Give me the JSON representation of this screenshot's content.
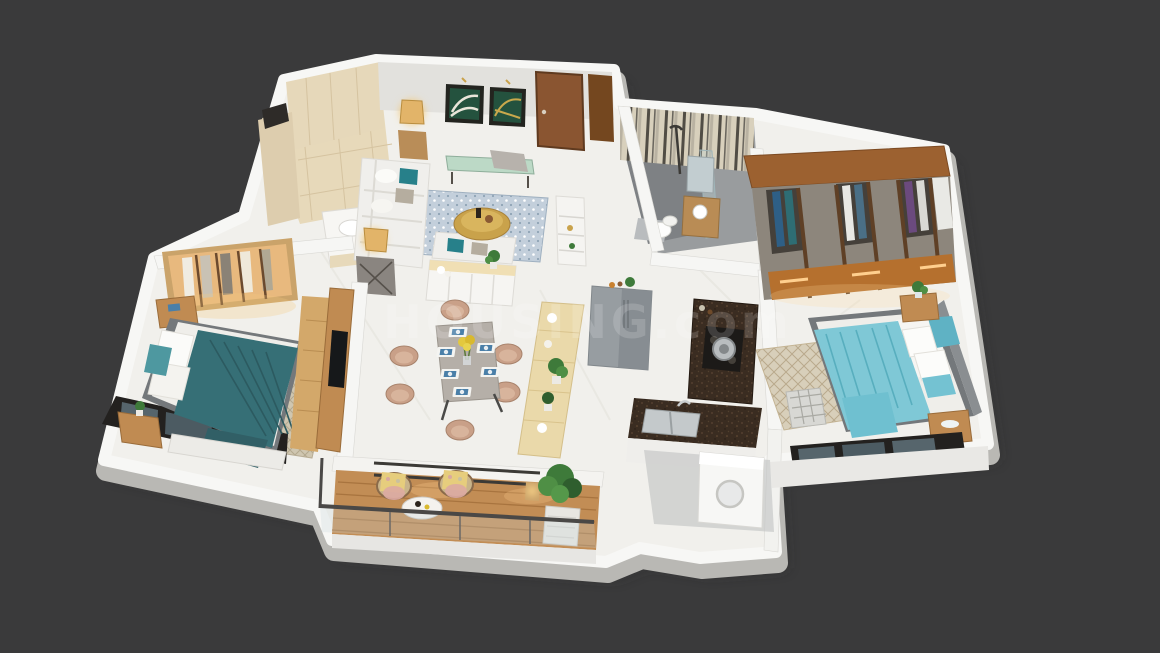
{
  "watermark": {
    "text": "HOUSING.com"
  },
  "scene": {
    "type": "3d-isometric-floor-plan-render",
    "description": "Photoreal 3D isometric cutaway floor plan of a 2-bedroom apartment on a dark charcoal background",
    "rooms": [
      {
        "name": "foyer",
        "furniture": [
          "beige-tiled-walls",
          "wash-basin-counter"
        ]
      },
      {
        "name": "living-room",
        "furniture": [
          "l-shaped-white-sofa",
          "teal-pillows",
          "two-wall-artworks",
          "wooden-entrance-door",
          "green-top-console",
          "round-gold-coffee-table",
          "blue-patterned-rug",
          "table-lamps",
          "white-sideboard"
        ]
      },
      {
        "name": "common-bathroom",
        "furniture": [
          "striped-tile-walls",
          "glass-shower",
          "wall-hung-toilet",
          "wood-vanity-with-basin",
          "mirror"
        ]
      },
      {
        "name": "dressing-room",
        "furniture": [
          "full-width-wardrobe",
          "hanging-clothes",
          "lit-drawers"
        ]
      },
      {
        "name": "master-bedroom",
        "furniture": [
          "aqua-duvet-bed",
          "white-and-aqua-pillows",
          "two-nightstands",
          "plaid-bench",
          "patterned-rug",
          "corner-windows"
        ]
      },
      {
        "name": "kitchen",
        "furniture": [
          "l-shaped-granite-counter",
          "gas-hob-with-pot",
          "double-sink",
          "grey-refrigerator"
        ]
      },
      {
        "name": "utility",
        "furniture": [
          "washing-machine"
        ]
      },
      {
        "name": "dining-area",
        "furniture": [
          "six-seater-table",
          "blush-chairs",
          "blue-placemats",
          "yellow-flower-vase"
        ]
      },
      {
        "name": "second-bedroom",
        "furniture": [
          "teal-duvet-bed",
          "lit-open-wardrobe",
          "tv-panel",
          "nightstands",
          "window-bench",
          "patterned-rug"
        ]
      },
      {
        "name": "balcony",
        "furniture": [
          "wood-deck",
          "glass-railing",
          "two-rattan-chairs",
          "round-bistro-table",
          "potted-plant",
          "lantern"
        ]
      },
      {
        "name": "passage",
        "furniture": [
          "wooden-console-strip",
          "planters",
          "white-display-unit"
        ]
      }
    ]
  },
  "palette": {
    "bg": "#3a3a3b",
    "floor": "#f1f0ec",
    "wallTop": "#f7f7f5",
    "wallShade": "#c9c8c4",
    "tileBeige": "#e7d9ba",
    "tileLine": "#d5c3a0",
    "bathStripeA": "#d8d0bc",
    "bathStripeB": "#514d45",
    "bathFloor": "#999c9e",
    "showerFloor": "#7e8184",
    "woodOak": "#c08b52",
    "woodLight": "#ead9aa",
    "woodDeck": "#c28d55",
    "woodDark": "#6b4a2e",
    "woodTop": "#9c6130",
    "tealDuvet": "#366f76",
    "tealPillow": "#4e98a0",
    "aquaDuvet": "#7fc8d6",
    "aquaDeep": "#5fb2c4",
    "sofa": "#f0efec",
    "accentTeal": "#27808a",
    "artGreen": "#24523e",
    "gold": "#c9a24b",
    "granite": "#3a2c21",
    "fridge": "#979da1",
    "chairBlush": "#c9a088",
    "tableTop": "#b5afa8",
    "placematBlue": "#4a7fa8",
    "rugBlue": "#c3cfdb",
    "rugBeige": "#d8cfba",
    "rugBedroom": "#cfc6b0",
    "lampGlow": "#f3c979",
    "plant": "#3e7a3a",
    "plantDark": "#2f5e2e",
    "frameDark": "#3a3833",
    "doorBrown": "#8a5531",
    "fabricTaupe": "#8d867c",
    "clothesBlue": "#2e5f86",
    "clothesPurple": "#6b4a7e",
    "drawerOrange": "#b5702e",
    "drawerGlow": "#ffcf8e",
    "bedFrame": "#74787b",
    "watermark": "rgba(255,255,255,0.16)"
  }
}
